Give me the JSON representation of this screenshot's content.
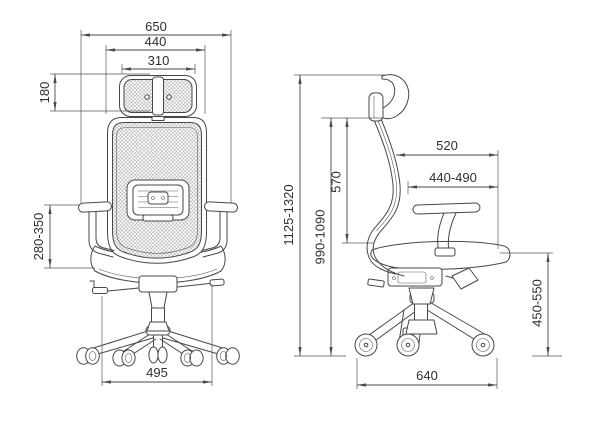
{
  "drawing": {
    "kind": "office-chair-dimension-drawing",
    "line_color": "#474747",
    "text_color": "#2f2f2f",
    "background": "#ffffff"
  },
  "front_view": {
    "name": "chair-front-view",
    "dims": {
      "overall_width": "650",
      "backrest_width": "440",
      "headrest_width": "310",
      "headrest_height": "180",
      "armrest_height": "280-350",
      "base_width": "495"
    }
  },
  "side_view": {
    "name": "chair-side-view",
    "dims": {
      "overall_height": "1125-1320",
      "backrest_top_height": "990-1090",
      "backrest_height": "570",
      "seat_total_depth": "520",
      "seat_depth": "440-490",
      "seat_height": "450-550",
      "base_depth": "640"
    }
  }
}
